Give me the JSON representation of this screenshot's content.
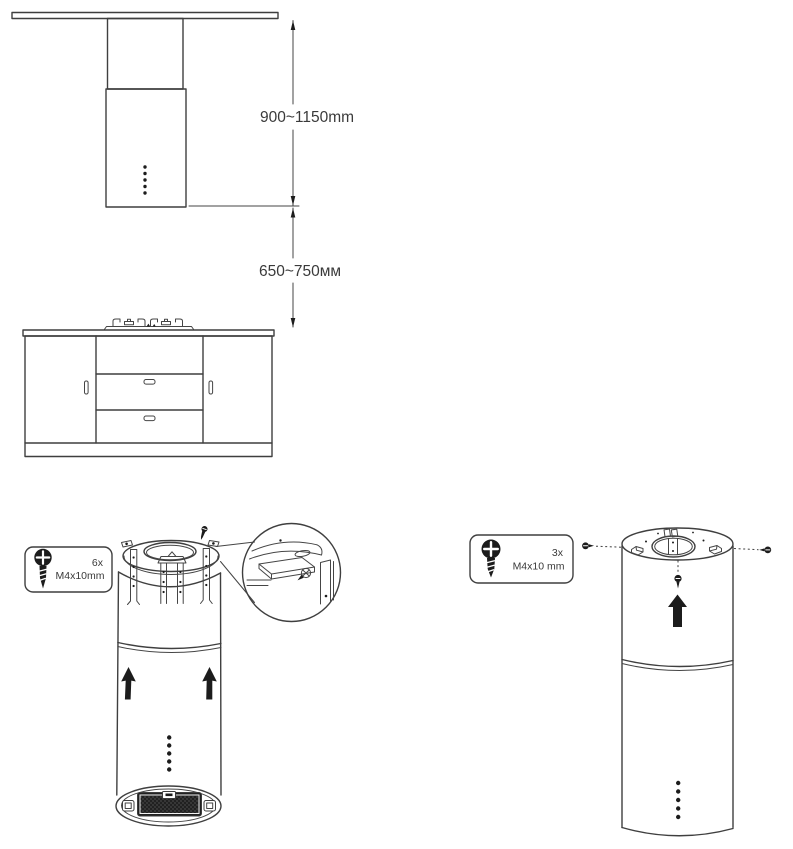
{
  "page": {
    "background": "#ffffff",
    "line_color": "#3f3f3f",
    "ink_color": "#1c1c1c",
    "text_color": "#3a3a3a"
  },
  "installation_diagram": {
    "dimension_ceiling_to_hood_bottom": "900~1150mm",
    "dimension_hood_bottom_to_cooktop": "650~750мм"
  },
  "bracket_step": {
    "screw_spec": {
      "quantity": "6x",
      "size": "M4x10mm"
    }
  },
  "mount_step": {
    "screw_spec": {
      "quantity": "3x",
      "size": "M4x10 mm"
    }
  },
  "icons": {
    "screw": "screw-icon",
    "up_arrow": "up-arrow-icon",
    "detail_view": "detail-circle"
  }
}
